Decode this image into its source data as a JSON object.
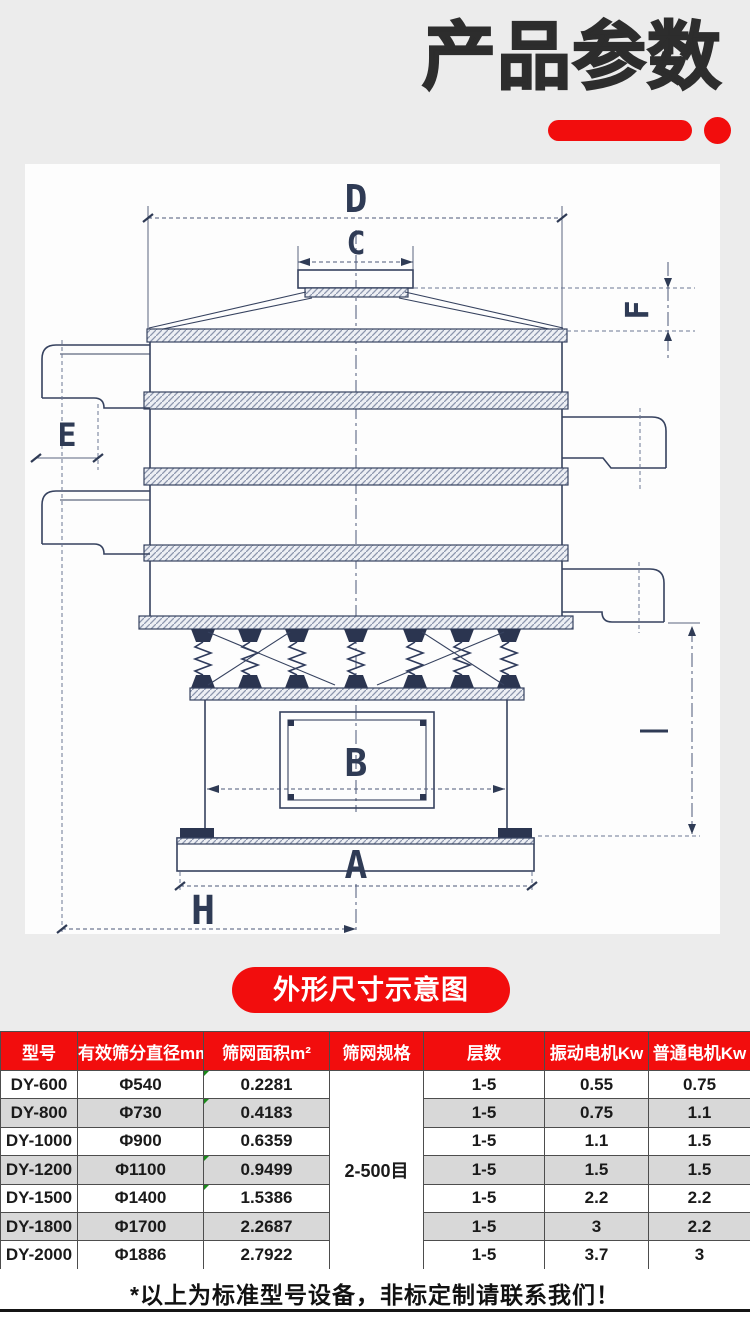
{
  "header": {
    "title": "产品参数"
  },
  "pill": {
    "label": "外形尺寸示意图"
  },
  "diagram": {
    "labels": {
      "d": "D",
      "c": "C",
      "e": "E",
      "f": "F",
      "b": "B",
      "a": "A",
      "h": "H"
    }
  },
  "table": {
    "headers": [
      "型号",
      "有效筛分直径mm",
      "筛网面积m²",
      "筛网规格",
      "层数",
      "振动电机Kw",
      "普通电机Kw"
    ],
    "merged_spec": "2-500目",
    "rows": [
      {
        "model": "DY-600",
        "diameter": "Φ540",
        "area": "0.2281",
        "layers": "1-5",
        "vib": "0.55",
        "ord": "0.75"
      },
      {
        "model": "DY-800",
        "diameter": "Φ730",
        "area": "0.4183",
        "layers": "1-5",
        "vib": "0.75",
        "ord": "1.1"
      },
      {
        "model": "DY-1000",
        "diameter": "Φ900",
        "area": "0.6359",
        "layers": "1-5",
        "vib": "1.1",
        "ord": "1.5"
      },
      {
        "model": "DY-1200",
        "diameter": "Φ1100",
        "area": "0.9499",
        "layers": "1-5",
        "vib": "1.5",
        "ord": "1.5"
      },
      {
        "model": "DY-1500",
        "diameter": "Φ1400",
        "area": "1.5386",
        "layers": "1-5",
        "vib": "2.2",
        "ord": "2.2"
      },
      {
        "model": "DY-1800",
        "diameter": "Φ1700",
        "area": "2.2687",
        "layers": "1-5",
        "vib": "3",
        "ord": "2.2"
      },
      {
        "model": "DY-2000",
        "diameter": "Φ1886",
        "area": "2.7922",
        "layers": "1-5",
        "vib": "3.7",
        "ord": "3"
      }
    ]
  },
  "footer": {
    "note": "*以上为标准型号设备，非标定制请联系我们！"
  },
  "colors": {
    "accent_red": "#f20d0d",
    "title_color": "#2d2d2d",
    "row_gray": "#d8d8d8",
    "drawing_line": "#36425f"
  }
}
